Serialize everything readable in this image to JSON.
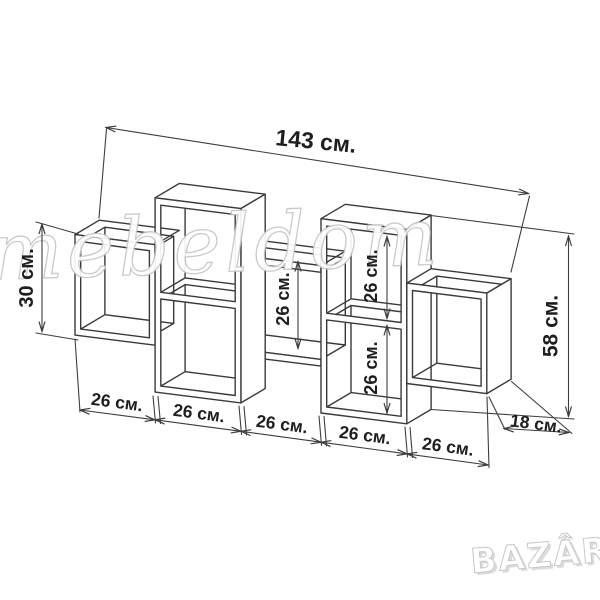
{
  "watermark": {
    "script_text": "mebeldom",
    "logo_text": "BAZÂR"
  },
  "dimensions": {
    "total_width": "143 см.",
    "left_cube_height": "30 см.",
    "center_section_height": "26 см.",
    "right_column_upper_height": "26 см.",
    "right_column_lower_height": "26 см.",
    "overall_height": "58 см.",
    "depth": "18 см.",
    "bottom_section_widths": [
      "26 см.",
      "26 см.",
      "26 см.",
      "26 см.",
      "26 см."
    ]
  }
}
